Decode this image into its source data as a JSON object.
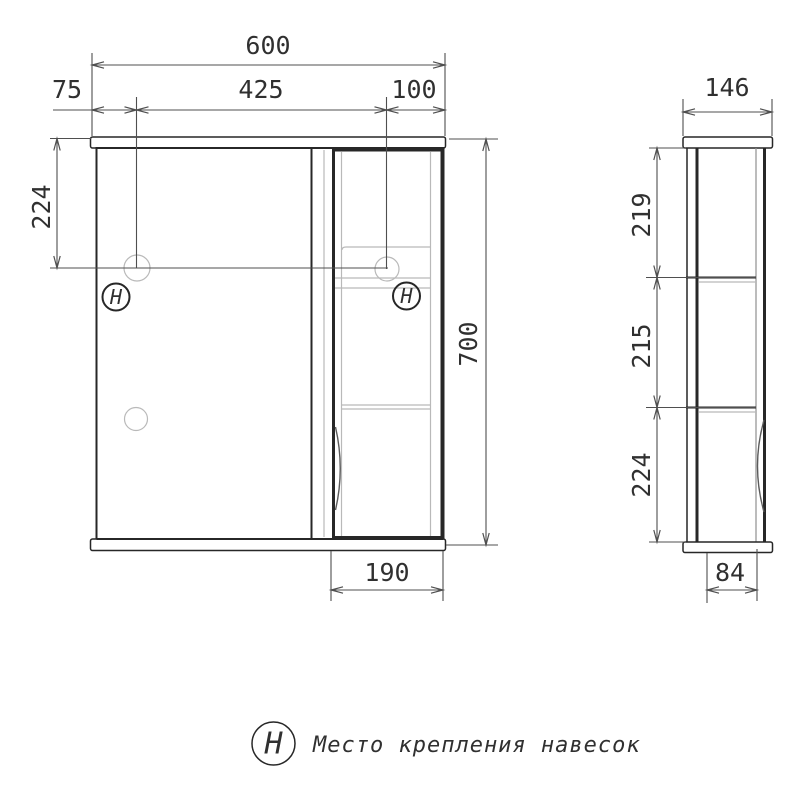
{
  "front_view": {
    "dim_width_total": "600",
    "dim_hanger_left_offset": "75",
    "dim_hanger_spacing": "425",
    "dim_hanger_right_offset": "100",
    "dim_hanger_from_top": "224",
    "dim_height_total": "700",
    "dim_right_section_width": "190",
    "hanger_mark": "Н"
  },
  "side_view": {
    "dim_depth_total": "146",
    "dim_section_top": "219",
    "dim_section_middle": "215",
    "dim_section_bottom": "224",
    "dim_body_depth": "84"
  },
  "legend": {
    "symbol": "Н",
    "label": "Место крепления навесок"
  },
  "colors": {
    "outline": "#272727",
    "dimension": "#4f4f4f",
    "light": "#b9b9b9",
    "text": "#303030",
    "background": "#ffffff"
  }
}
